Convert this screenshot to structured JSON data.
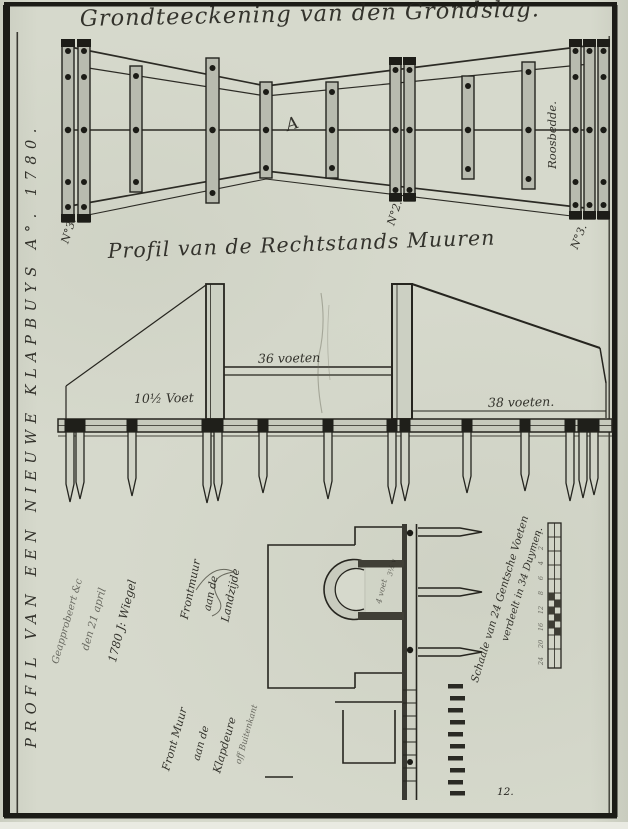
{
  "sheet": {
    "side_title": "PROFIL VAN EEN NIEUWE KLAPBUYS A°. 1780.",
    "page_number": "12."
  },
  "plan": {
    "title": "Grondteeckening van den Grondslag.",
    "marker_a": "A",
    "beam_no_left": "N°3.",
    "beam_no_mid": "N°2.",
    "beam_no_right": "N°3.",
    "rosebed_label": "Roosbedde."
  },
  "profile": {
    "title": "Profil van de Rechtstands Muuren",
    "dim_left": "10½ Voet",
    "dim_middle": "36 voeten",
    "dim_right": "38 voeten."
  },
  "details": {
    "approval_line1": "Geapprobeert &c",
    "approval_line2": "den 21 april",
    "approval_line3": "1780 J: Wiegel",
    "front_land_line1": "Frontmuur",
    "front_land_line2": "aan de",
    "front_land_line3": "Landzijde",
    "front_sea_line1": "Front Muur",
    "front_sea_line2": "aan de",
    "front_sea_line3": "Klapdeure",
    "front_sea_line4": "off Buitenkant",
    "arch_dim1": "4 voet",
    "arch_dim2": "3½ v",
    "scale_caption_line1": "Schaale van 24 Gentsche Voeten",
    "scale_caption_line2": "verdeelt in 34 Duymen.",
    "scale_ticks": [
      "24",
      "20",
      "16",
      "12",
      "8",
      "6",
      "4",
      "2",
      "1"
    ]
  },
  "colors": {
    "paper": "#d6d9cc",
    "ink": "#26251f",
    "timber_fill": "#b8bbaf",
    "dark_cap": "#1d1d18"
  }
}
